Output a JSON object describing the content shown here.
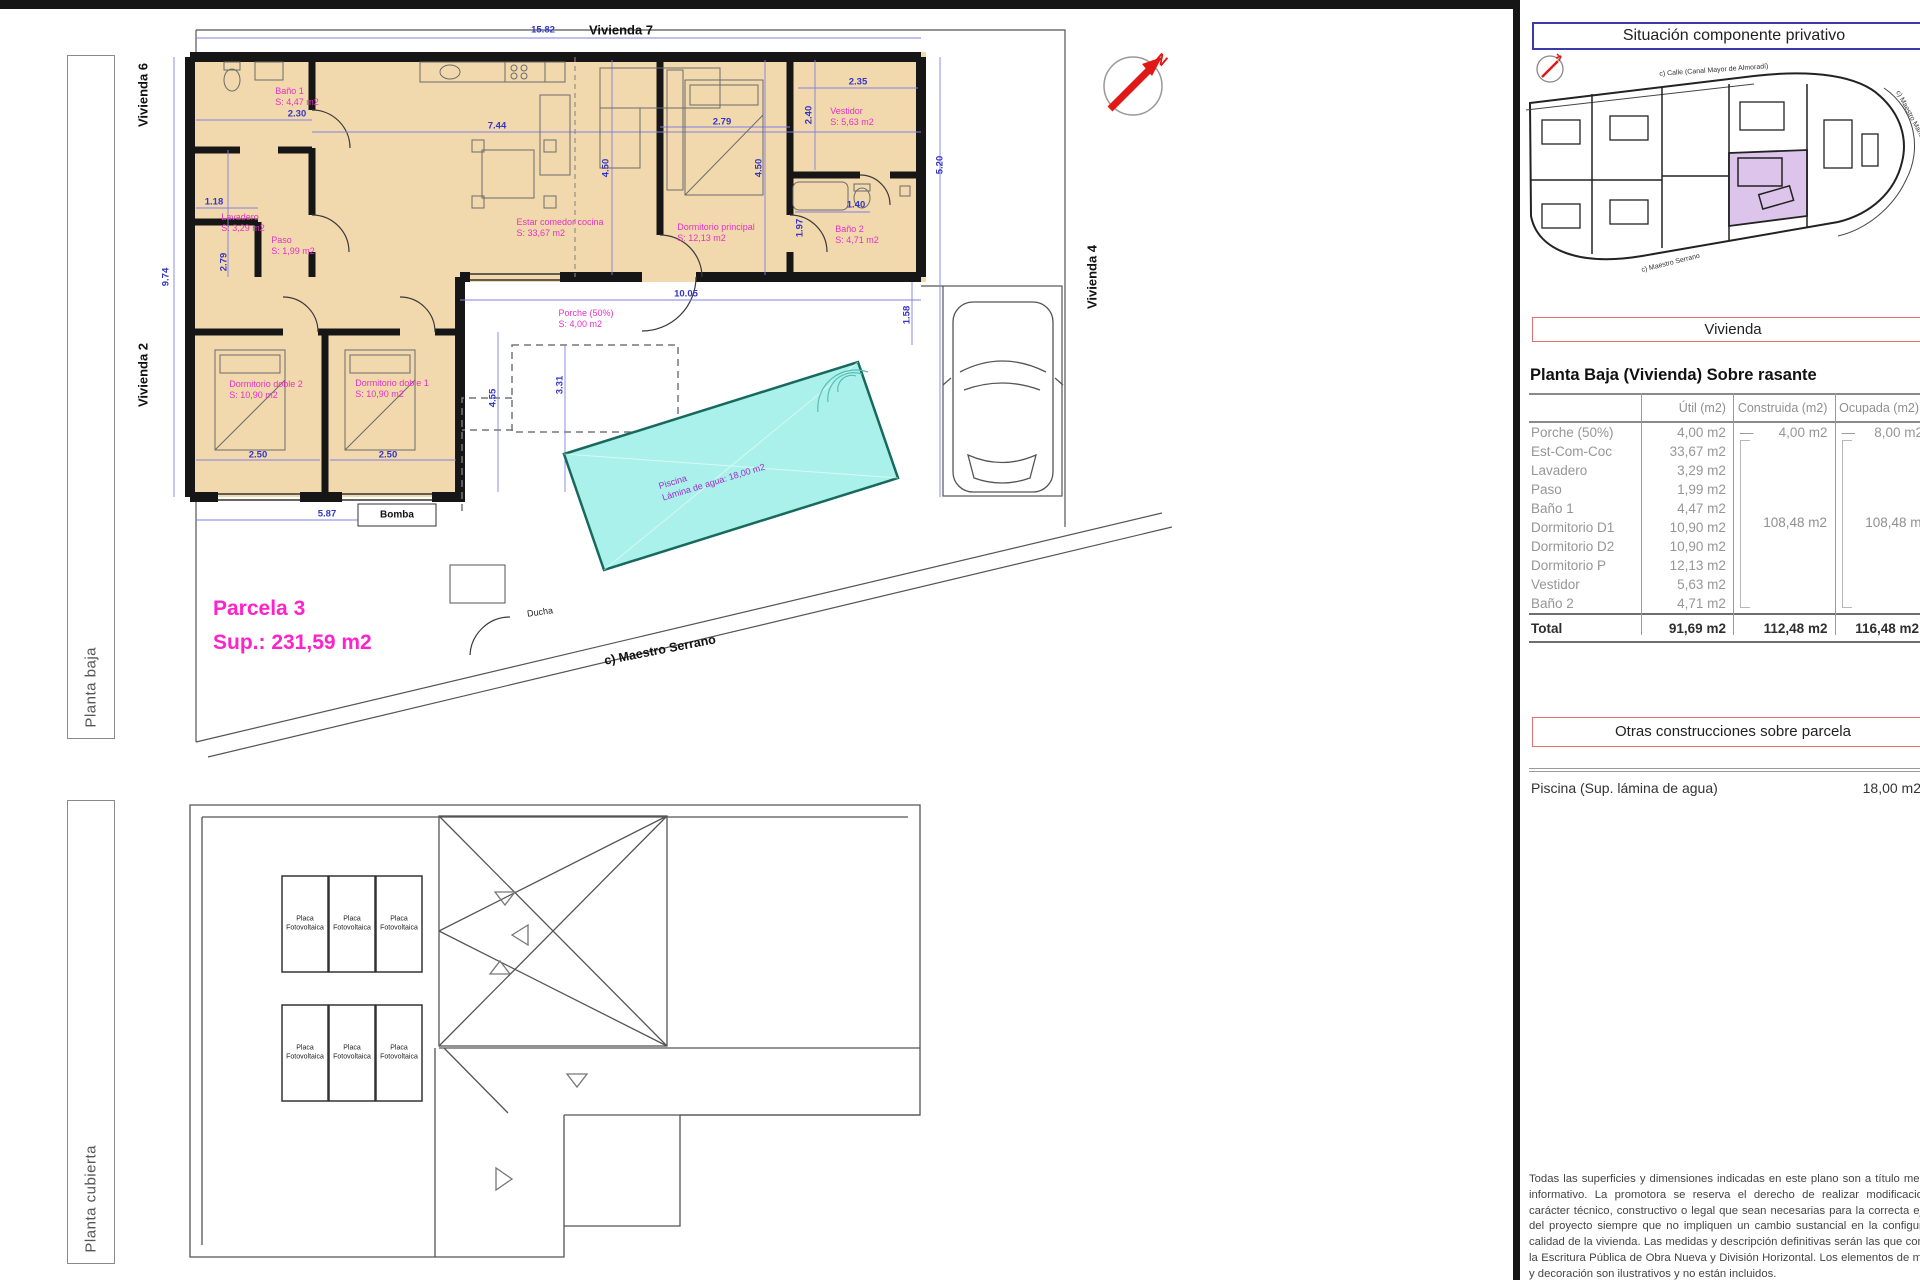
{
  "colors": {
    "wall": "#161616",
    "room_fill": "#f2d9ad",
    "dim_blue": "#3434c8",
    "room_magenta": "#e431c4",
    "parcela_magenta": "#ff22cc",
    "pool_fill": "#a9f1ea",
    "pool_border": "#17695e",
    "minimap_highlight": "#dcc4ea",
    "red_box_border": "#e07070",
    "blue_box_border": "#3a3aa8",
    "north_red": "#e01818"
  },
  "sidebar": {
    "baja": "Planta baja",
    "cubierta": "Planta cubierta"
  },
  "titles": {
    "situacion": "Situación componente privativo",
    "vivienda": "Vivienda",
    "planta_heading": "Planta Baja (Vivienda) Sobre rasante",
    "otras": "Otras construcciones sobre parcela"
  },
  "minimap": {
    "street_top": "c) Calle (Canal Mayor de Almoradí)",
    "street_bottom": "c) Maestro Serrano",
    "street_right": "c) Maestro Manuel Quislant"
  },
  "table": {
    "columns": [
      "",
      "Útil (m2)",
      "Construida (m2)",
      "Ocupada (m2)"
    ],
    "dash": "—",
    "rows": [
      {
        "label": "Porche (50%)",
        "util": "4,00 m2",
        "construida": "4,00 m2",
        "ocupada": "8,00 m2"
      },
      {
        "label": "Est-Com-Coc",
        "util": "33,67 m2"
      },
      {
        "label": "Lavadero",
        "util": "3,29 m2"
      },
      {
        "label": "Paso",
        "util": "1,99 m2"
      },
      {
        "label": "Baño 1",
        "util": "4,47 m2"
      },
      {
        "label": "Dormitorio D1",
        "util": "10,90 m2"
      },
      {
        "label": "Dormitorio D2",
        "util": "10,90 m2"
      },
      {
        "label": "Dormitorio P",
        "util": "12,13 m2"
      },
      {
        "label": "Vestidor",
        "util": "5,63 m2"
      },
      {
        "label": "Baño 2",
        "util": "4,71 m2"
      }
    ],
    "group_construida": "108,48 m2",
    "group_ocupada": "108,48 m2",
    "total": {
      "label": "Total",
      "util": "91,69 m2",
      "construida": "112,48 m2",
      "ocupada": "116,48 m2"
    }
  },
  "otras_rows": [
    {
      "label": "Piscina (Sup. lámina de agua)",
      "value": "18,00 m2"
    }
  ],
  "disclaimer": "Todas las superficies y dimensiones indicadas en este plano son a título meramente informativo. La promotora se reserva el derecho de realizar modificaciones de carácter técnico, constructivo o legal que sean necesarias para la correcta ejecución del proyecto siempre que no impliquen un cambio sustancial en la configuración o calidad de la vivienda. Las medidas y descripción definitivas serán las que consten en la Escritura Pública de Obra Nueva y División Horizontal. Los elementos de mobiliario y decoración son ilustrativos y no están incluidos.",
  "plan": {
    "parcela": {
      "line1": "Parcela 3",
      "line2": "Sup.: 231,59 m2"
    },
    "pool": {
      "line1": "Piscina",
      "line2": "Lámina de agua: 18,00 m2"
    },
    "neighbor_labels": [
      {
        "t": "Vivienda 7",
        "x": 621,
        "y": 30,
        "r": 0
      },
      {
        "t": "Vivienda 6",
        "x": 143,
        "y": 95,
        "r": -90
      },
      {
        "t": "Vivienda 2",
        "x": 143,
        "y": 375,
        "r": -90
      },
      {
        "t": "Vivienda 4",
        "x": 1092,
        "y": 277,
        "r": -90
      }
    ],
    "room_labels": [
      {
        "n": "Baño 1",
        "a": "S: 4,47 m2",
        "x": 297,
        "y": 97
      },
      {
        "n": "Lavadero",
        "a": "S: 3,29 m2",
        "x": 243,
        "y": 223
      },
      {
        "n": "Paso",
        "a": "S: 1,99 m2",
        "x": 293,
        "y": 246
      },
      {
        "n": "Estar comedor cocina",
        "a": "S: 33,67 m2",
        "x": 560,
        "y": 228
      },
      {
        "n": "Dormitorio principal",
        "a": "S: 12,13 m2",
        "x": 716,
        "y": 233
      },
      {
        "n": "Vestidor",
        "a": "S: 5,63 m2",
        "x": 852,
        "y": 117
      },
      {
        "n": "Baño 2",
        "a": "S: 4,71 m2",
        "x": 857,
        "y": 235
      },
      {
        "n": "Dormitorio doble 2",
        "a": "S: 10,90 m2",
        "x": 266,
        "y": 390
      },
      {
        "n": "Dormitorio doble 1",
        "a": "S: 10,90 m2",
        "x": 392,
        "y": 389
      },
      {
        "n": "Porche (50%)",
        "a": "S: 4,00 m2",
        "x": 586,
        "y": 319
      }
    ],
    "dim_labels": [
      {
        "t": "15.82",
        "x": 543,
        "y": 30,
        "r": 0
      },
      {
        "t": "7.44",
        "x": 497,
        "y": 126,
        "r": 0
      },
      {
        "t": "2.30",
        "x": 297,
        "y": 114,
        "r": 0
      },
      {
        "t": "1.18",
        "x": 214,
        "y": 202,
        "r": 0
      },
      {
        "t": "2.79",
        "x": 224,
        "y": 262,
        "r": -90
      },
      {
        "t": "9.74",
        "x": 166,
        "y": 277,
        "r": -90
      },
      {
        "t": "4.50",
        "x": 606,
        "y": 168,
        "r": -90
      },
      {
        "t": "4.50",
        "x": 759,
        "y": 168,
        "r": -90
      },
      {
        "t": "2.79",
        "x": 722,
        "y": 122,
        "r": 0
      },
      {
        "t": "2.35",
        "x": 858,
        "y": 82,
        "r": 0
      },
      {
        "t": "2.40",
        "x": 809,
        "y": 115,
        "r": -90
      },
      {
        "t": "5.20",
        "x": 940,
        "y": 165,
        "r": -90
      },
      {
        "t": "1.40",
        "x": 856,
        "y": 205,
        "r": 0
      },
      {
        "t": "1.97",
        "x": 800,
        "y": 228,
        "r": -90
      },
      {
        "t": "1.58",
        "x": 907,
        "y": 315,
        "r": -90
      },
      {
        "t": "10.05",
        "x": 686,
        "y": 294,
        "r": 0
      },
      {
        "t": "4.55",
        "x": 493,
        "y": 398,
        "r": -90
      },
      {
        "t": "3.31",
        "x": 560,
        "y": 385,
        "r": -90
      },
      {
        "t": "2.50",
        "x": 258,
        "y": 455,
        "r": 0
      },
      {
        "t": "2.50",
        "x": 388,
        "y": 455,
        "r": 0
      },
      {
        "t": "5.87",
        "x": 327,
        "y": 514,
        "r": 0
      }
    ],
    "misc_labels": [
      {
        "t": "Bomba",
        "x": 397,
        "y": 515,
        "r": 0,
        "cls": "lbl-bold-sm"
      },
      {
        "t": "Ducha",
        "x": 540,
        "y": 612,
        "r": -8,
        "cls": "lbl-sm"
      },
      {
        "t": "c) Maestro Serrano",
        "x": 660,
        "y": 650,
        "r": -11,
        "cls": "lbl-street"
      },
      {
        "t": "N",
        "x": 1161,
        "y": 60,
        "r": 40,
        "cls": "lbl-n"
      }
    ]
  },
  "roof": {
    "panel_line1": "Placa",
    "panel_line2": "Fotovoltaica",
    "panel_positions": [
      {
        "x": 305,
        "y": 924
      },
      {
        "x": 352,
        "y": 924
      },
      {
        "x": 399,
        "y": 924
      },
      {
        "x": 305,
        "y": 1053
      },
      {
        "x": 352,
        "y": 1053
      },
      {
        "x": 399,
        "y": 1053
      }
    ]
  }
}
